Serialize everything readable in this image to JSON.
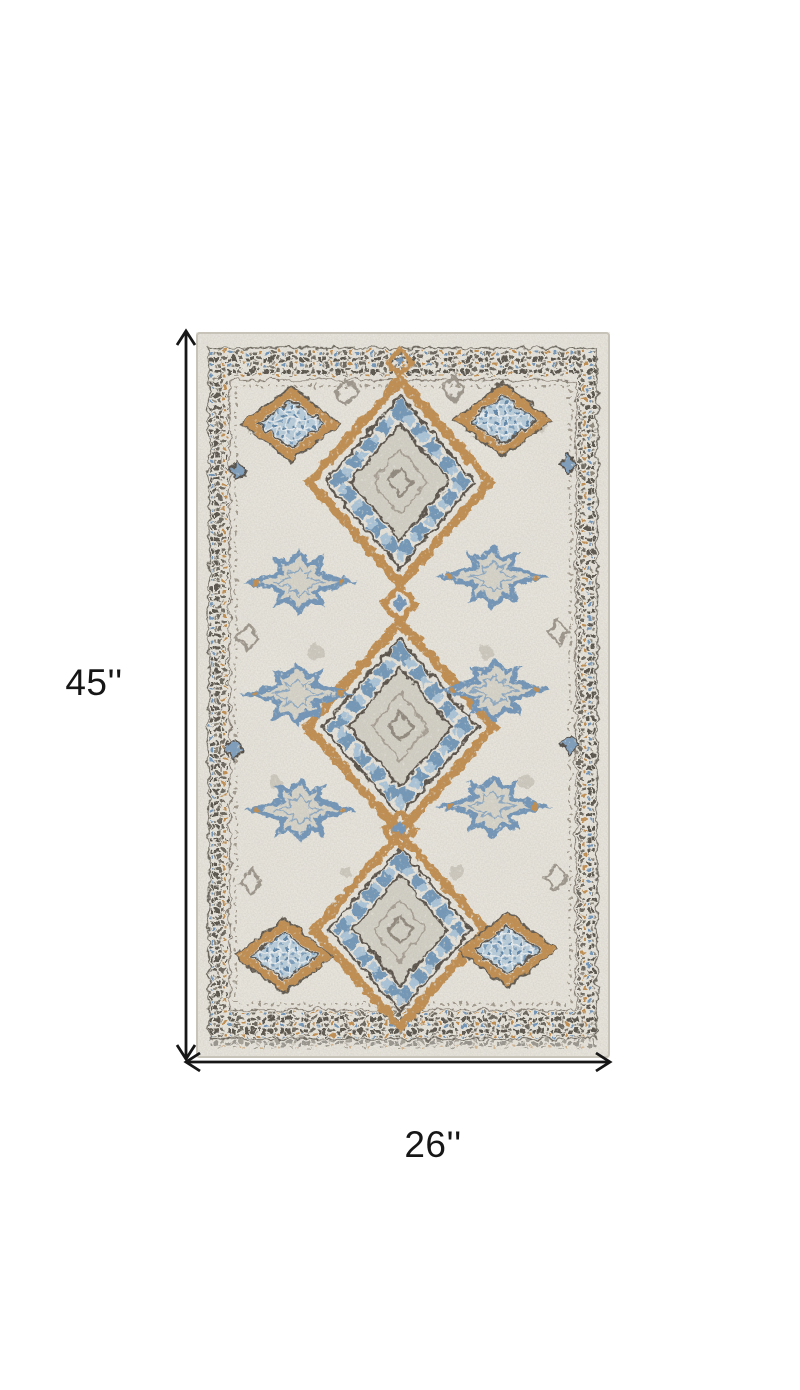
{
  "diagram": {
    "type": "product-dimension-diagram",
    "subject": "ivory grey and blue distressed moroccan diamond area rug, top view",
    "height_label": "45''",
    "width_label": "26''"
  },
  "colors": {
    "page_background": "#ffffff",
    "arrow": "#161616",
    "rug_ivory": "#e8e5dd",
    "rug_field_gray": "#d3cfc5",
    "rug_charcoal": "#564f47",
    "rug_tan_gold": "#c08c4e",
    "rug_blue": "#6f94b8",
    "rug_light_blue": "#b7cddc"
  }
}
